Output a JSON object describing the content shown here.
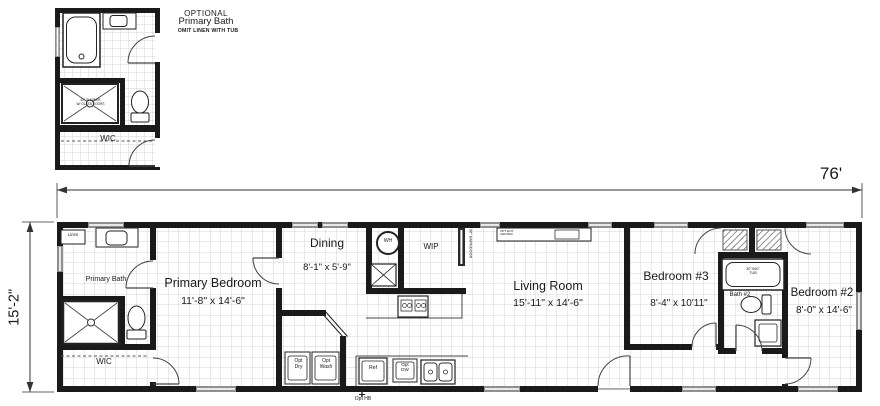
{
  "drawing": {
    "type": "manufactured home floor plan"
  },
  "detail_plan": {
    "title_line1": "OPTIONAL",
    "title_line2": "Primary Bath",
    "note": "OMIT LINEN WITH TUB",
    "shower_note_line1": "42\" SHOWER",
    "shower_note_line2": "W/ GLASS DOORS",
    "wic": "WIC"
  },
  "dimensions": {
    "overall_width": "76'",
    "overall_height": "15'-2\""
  },
  "rooms": {
    "primary_bedroom": {
      "name": "Primary Bedroom",
      "size": "11'-8\" x 14'-6\""
    },
    "primary_bath": {
      "name": "Primary Bath"
    },
    "wic": {
      "name": "WIC"
    },
    "dining": {
      "name": "Dining",
      "size": "8'-1\" x 5'-9\""
    },
    "wip": {
      "name": "WIP"
    },
    "living_room": {
      "name": "Living Room",
      "size": "15'-11\" x 14'-6\""
    },
    "bedroom3": {
      "name": "Bedroom #3",
      "size": "8'-4\" x 10'11\""
    },
    "bath2": {
      "name": "Bath #2"
    },
    "bedroom2": {
      "name": "Bedroom #2",
      "size": "8'-0\" x 14'-6\""
    }
  },
  "fixtures": {
    "linen": "Linen",
    "water_heater": "WH",
    "tub_line1": "30\"X60\"",
    "tub_line2": "TUB",
    "opt_dryer_line1": "Opt",
    "opt_dryer_line2": "Dry",
    "opt_washer_line1": "Opt",
    "opt_washer_line2": "Wash",
    "refrigerator": "Ref",
    "opt_dishwasher_line1": "Opt",
    "opt_dishwasher_line2": "DW",
    "opt_hose_bib": "Opt HB",
    "barn_door": "36\" BARNDOOR",
    "ent_center_line1": "OPT ENT",
    "ent_center_line2": "CENTER"
  }
}
